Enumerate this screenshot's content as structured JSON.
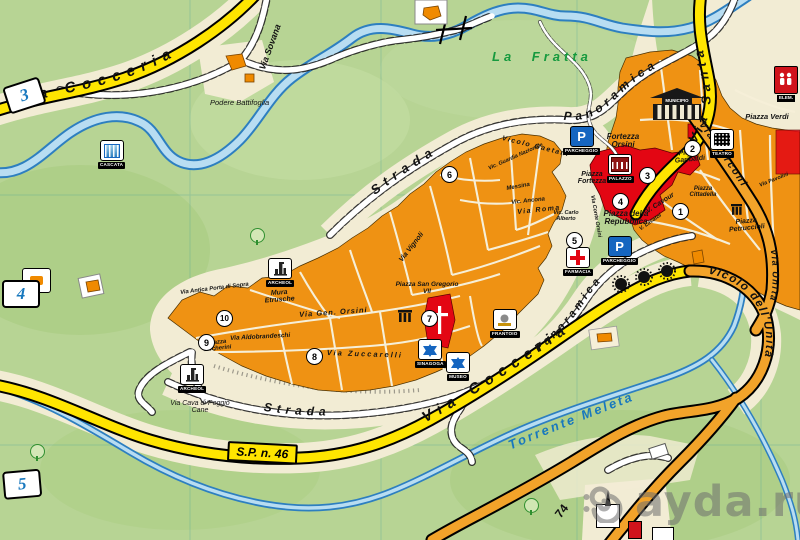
{
  "map": {
    "watermark": "ayda.ru",
    "glyphs": {
      "parking": "P"
    },
    "roads": {
      "cocceria_top": "Via Cocceria",
      "cocceria_bottom": "Via Cocceria",
      "sp46": "S.P. n. 46",
      "strada_north": "Strada",
      "panoramica_north": "Panoramica",
      "strada_south": "Strada",
      "panoramica_south": "Panoramica",
      "via_santa": "Via Santa",
      "via_sovana": "Via Sovana",
      "vicolo_unita": "Vicolo dell'Unità",
      "via_unita": "Via Unità",
      "via_marconi": "Via Marconi",
      "route_74": "74",
      "torrente_meleta": "Torrente Meleta"
    },
    "areas": {
      "la_fratta": "La Fratta",
      "podere": "Podere Battifoglia",
      "fortezza_orsini": "Fortezza Orsini",
      "mura_etrusche": "Mura Etrusche",
      "via_cava": "Via Cava di Poggio Cane"
    },
    "piazzas": {
      "verdi": "Piazza Verdi",
      "garibaldi": "Piazza Garibaldi",
      "repubblica": "Piazza della Repubblica",
      "fortezza": "Piazza Fortezza",
      "cittadella": "Piazza Cittadella",
      "petruccioli": "Piazza Petruccioli",
      "san_gregorio": "Piazza San Gregorio VII",
      "becherini": "Piazza Becherini"
    },
    "streets": {
      "roma": "Via Roma",
      "zuccarelli": "Via Zuccarelli",
      "gen_orsini": "Via Gen. Orsini",
      "aldobrandeschi": "Via Aldobrandeschi",
      "antica_porta": "Via Antica Porta di Sopra",
      "vignoli": "Via Vignoli",
      "conte_orsini": "Via Conte Orsini",
      "carlo_alberto": "Vic. Carlo Alberto",
      "cavour": "V. Cavour",
      "messina": "Messina",
      "ancona": "Vic. Ancona",
      "guardia_nazionale": "Vic. Guardia Nazionale",
      "gaetani": "Vicolo Gaetani",
      "pavolini": "Via Pavolini",
      "lavatoi": "V. Lavatoi"
    },
    "poi": {
      "cascata": "CASCATA",
      "archeo_north": "ARCHEOL",
      "archeo_south": "ARCHEOL",
      "parking_north": "PARCHEGGIO",
      "parking_south": "PARCHEGGIO",
      "farmacia": "FARMACIA",
      "sinagoga": "SINAGOGA",
      "museo": "MUSEO",
      "frantoio": "FRANTOIO",
      "teatro": "TEATRO",
      "palazzo": "PALAZZO",
      "municipio": "MUNICIPIO",
      "elem": "ELEM."
    },
    "markers": {
      "m1": "1",
      "m2": "2",
      "m3": "3",
      "m4": "4",
      "m5": "5",
      "m6": "6",
      "m7": "7",
      "m8": "8",
      "m9": "9",
      "m10": "10"
    },
    "edge_markers": {
      "e3": "3",
      "e4": "4",
      "e5": "5"
    },
    "colors": {
      "water": "#2d7fc0",
      "water_light": "#b8ddf2",
      "road_yellow": "#ffe500",
      "road_orange": "#f2a32a",
      "town_orange": "#ef9213",
      "building_red": "#e30613",
      "terrain": "#f2ecd4",
      "background_green": "#b7d494",
      "label_green": "#169a3e",
      "label_blue": "#1878be"
    }
  }
}
